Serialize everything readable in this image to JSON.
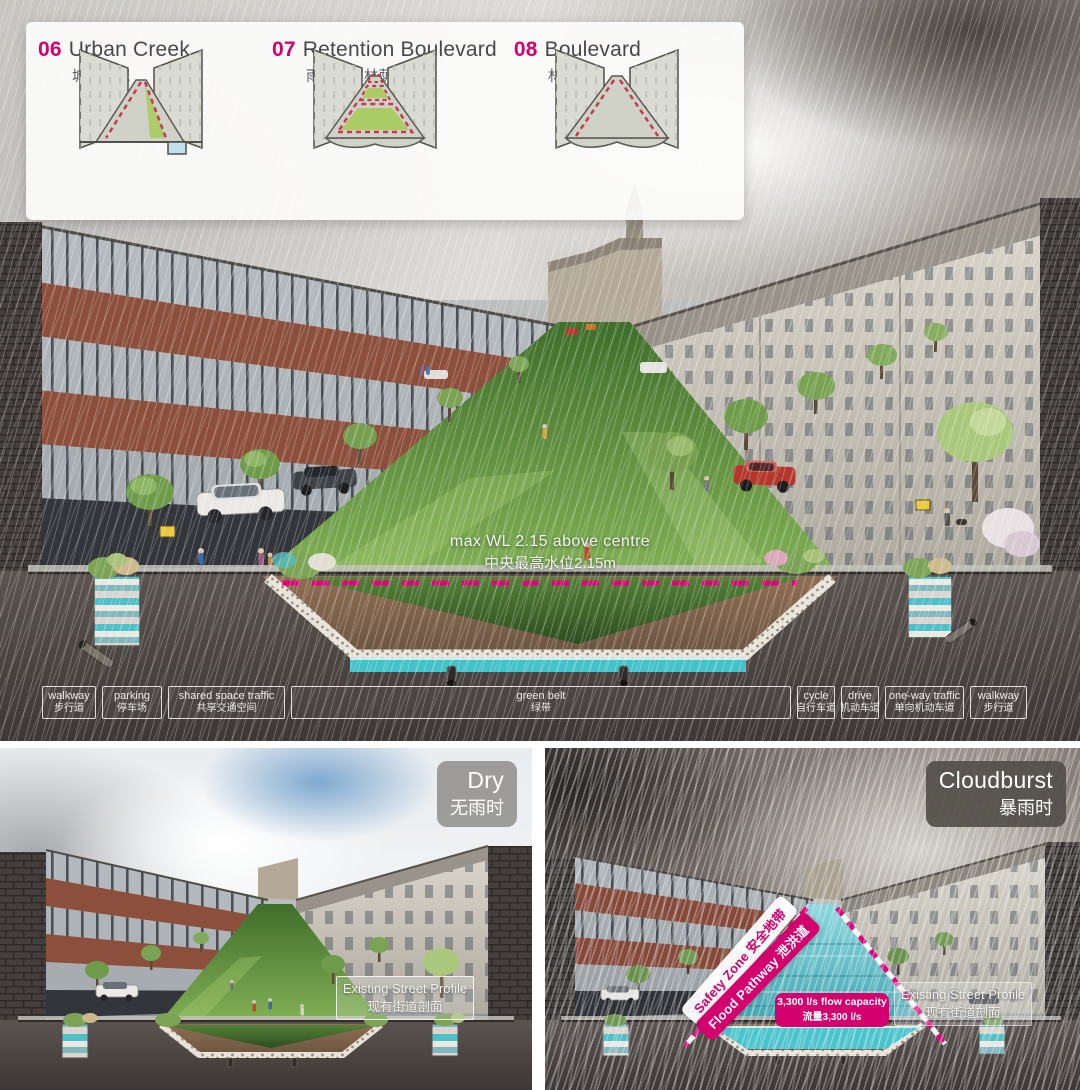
{
  "colors": {
    "accent_magenta": "#d4006e",
    "dashed_waterline": "#e2007d",
    "water_teal": "#44c2ca",
    "soil_dark": "#4b4543",
    "lawn_green": "#6ba145",
    "legend_panel_bg": "rgba(252,252,251,0.93)",
    "badge_dry_bg": "#92918d",
    "badge_cloudburst_bg": "#534e49"
  },
  "legend": {
    "items": [
      {
        "num": "06",
        "title": "Urban Creek",
        "zh": "城市溪流"
      },
      {
        "num": "07",
        "title": "Retention Boulevard",
        "zh": "雨水滞留林荫道"
      },
      {
        "num": "08",
        "title": "Boulevard",
        "zh": "林荫道"
      }
    ]
  },
  "main": {
    "annotation": {
      "en": "max WL 2.15 above centre",
      "zh": "中央最高水位2.15m"
    },
    "zones": [
      {
        "en": "walkway",
        "zh": "步行道"
      },
      {
        "en": "parking",
        "zh": "停车场"
      },
      {
        "en": "shared space traffic",
        "zh": "共享交通空间"
      },
      {
        "en": "green belt",
        "zh": "绿带"
      },
      {
        "en": "cycle",
        "zh": "自行车道"
      },
      {
        "en": "drive",
        "zh": "机动车道"
      },
      {
        "en": "one-way traffic",
        "zh": "单向机动车道"
      },
      {
        "en": "walkway",
        "zh": "步行道"
      }
    ]
  },
  "dry": {
    "badge": {
      "en": "Dry",
      "zh": "无雨时"
    },
    "profile": {
      "en": "Existing Street Profile",
      "zh": "现有街道剖面"
    }
  },
  "cloudburst": {
    "badge": {
      "en": "Cloudburst",
      "zh": "暴雨时"
    },
    "safety_zone": {
      "en": "Safety Zone",
      "zh": "安全地带"
    },
    "flood_pathway": {
      "en": "Flood Pathway",
      "zh": "泄洪道"
    },
    "capacity": {
      "en": "3,300 l/s flow capacity",
      "zh": "流量3,300 l/s"
    },
    "profile": {
      "en": "Existing Street Profile",
      "zh": "现有街道剖面"
    }
  }
}
